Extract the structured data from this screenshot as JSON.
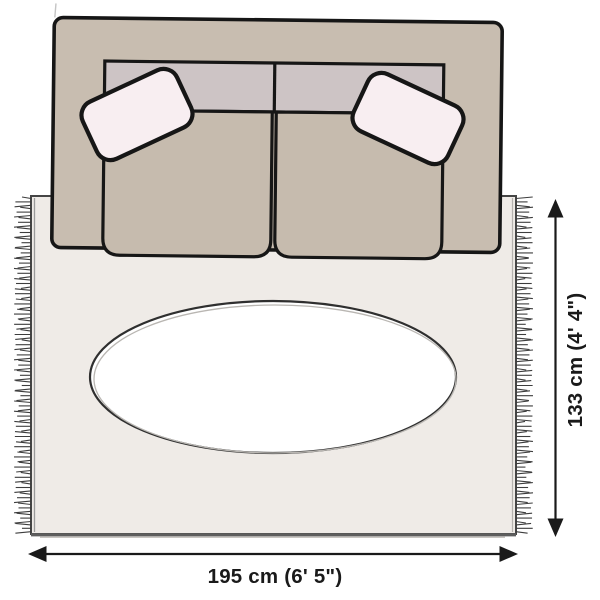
{
  "labels": {
    "rug_width": "195 cm (6' 5\")",
    "rug_height": "133 cm (4' 4\")"
  },
  "colors": {
    "sofa_body": "#c8bdb0",
    "sofa_backrest": "#cdc4c5",
    "seat_cushion": "#c6bbae",
    "pillow": "#f8eef1",
    "rug": "#efebe7",
    "outline": "#1b1b1b",
    "fringe": "#3d3d3d",
    "arrow": "#1a1a1a"
  }
}
